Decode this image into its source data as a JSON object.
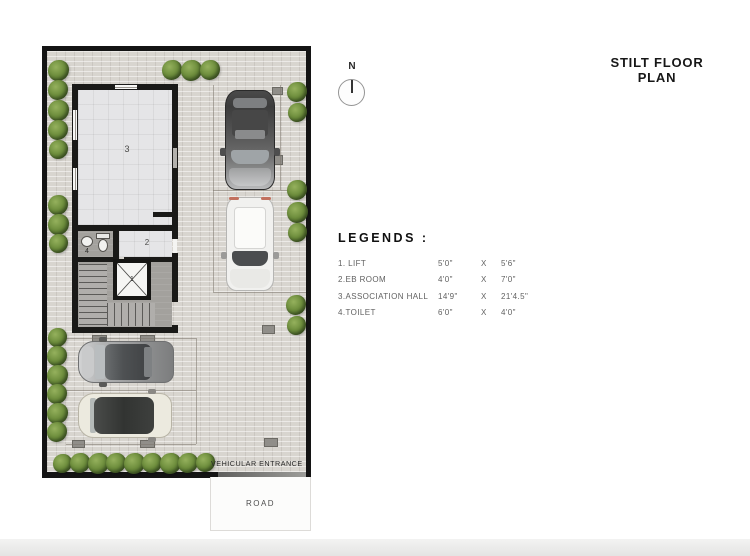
{
  "title": "STILT FLOOR PLAN",
  "north": {
    "label": "N"
  },
  "legend": {
    "heading": "LEGENDS :",
    "items": [
      {
        "name": "1. LIFT",
        "dim1": "5'0\"",
        "sep": "X",
        "dim2": "5'6\""
      },
      {
        "name": "2.EB ROOM",
        "dim1": "4'0\"",
        "sep": "X",
        "dim2": "7'0\""
      },
      {
        "name": "3.ASSOCIATION HALL",
        "dim1": "14'9\"",
        "sep": "X",
        "dim2": "21'4.5\""
      },
      {
        "name": "4.TOILET",
        "dim1": "6'0\"",
        "sep": "X",
        "dim2": "4'0\""
      }
    ]
  },
  "plan": {
    "room_labels": {
      "lift": "1",
      "eb_room": "2",
      "hall": "3",
      "toilet": "4"
    },
    "vehicular_entrance_label": "VEHICULAR ENTRANCE",
    "road_label": "ROAD"
  },
  "colors": {
    "wall": "#1a1a18",
    "paving": "#d8d5cf",
    "hall_floor": "#e5e5e7",
    "lobby_floor": "#a3a19d",
    "bush_green": "#6e8e3d",
    "car_dark": "#4a4a4a",
    "car_white": "#f1f1ef",
    "car_silver": "#a7a8a9",
    "car_cream": "#eceadf"
  }
}
